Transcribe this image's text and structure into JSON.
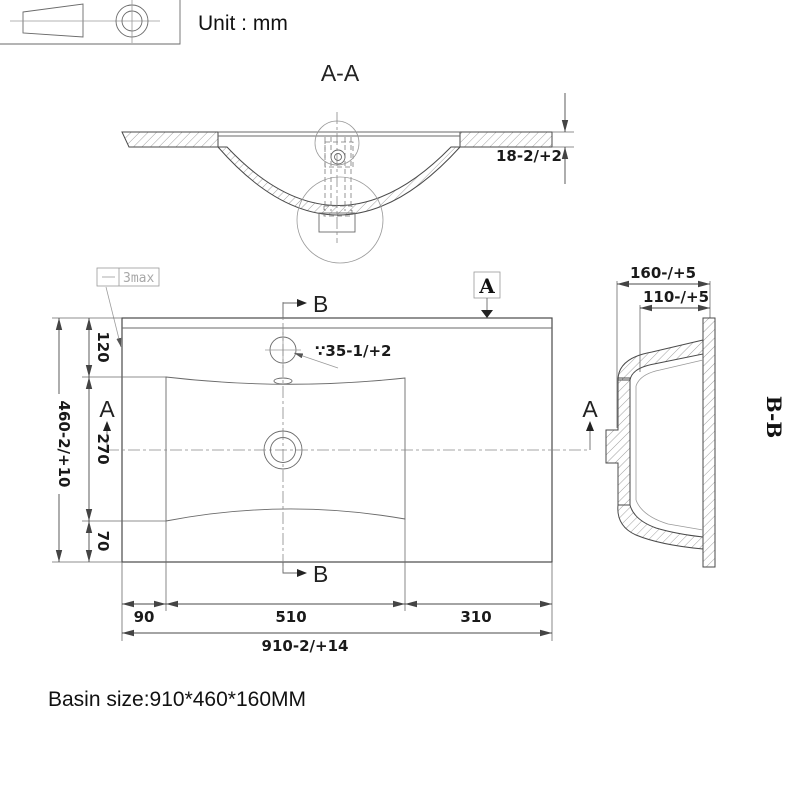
{
  "unit_label": "Unit : mm",
  "section_aa": {
    "label": "A-A",
    "thickness_dim": "18-2/+2"
  },
  "plan": {
    "flatness_tolerance": "3max",
    "faucet_hole_dim": "∵35-1/+2",
    "marker_a": "A",
    "marker_b": "B",
    "left_dims": {
      "top": "120",
      "middle": "270",
      "bottom": "70",
      "overall": "460-2/+10"
    },
    "bottom_dims": {
      "left": "90",
      "center": "510",
      "right": "310",
      "overall": "910-2/+14"
    }
  },
  "section_bb": {
    "label": "B-B",
    "overall_depth": "160-/+5",
    "inner_depth": "110-/+5"
  },
  "footer": {
    "basin_size": "Basin size:910*460*160MM"
  },
  "colors": {
    "line": "#4a4a4a",
    "light_line": "#9a9a9a",
    "text": "#111111",
    "background": "#ffffff"
  }
}
